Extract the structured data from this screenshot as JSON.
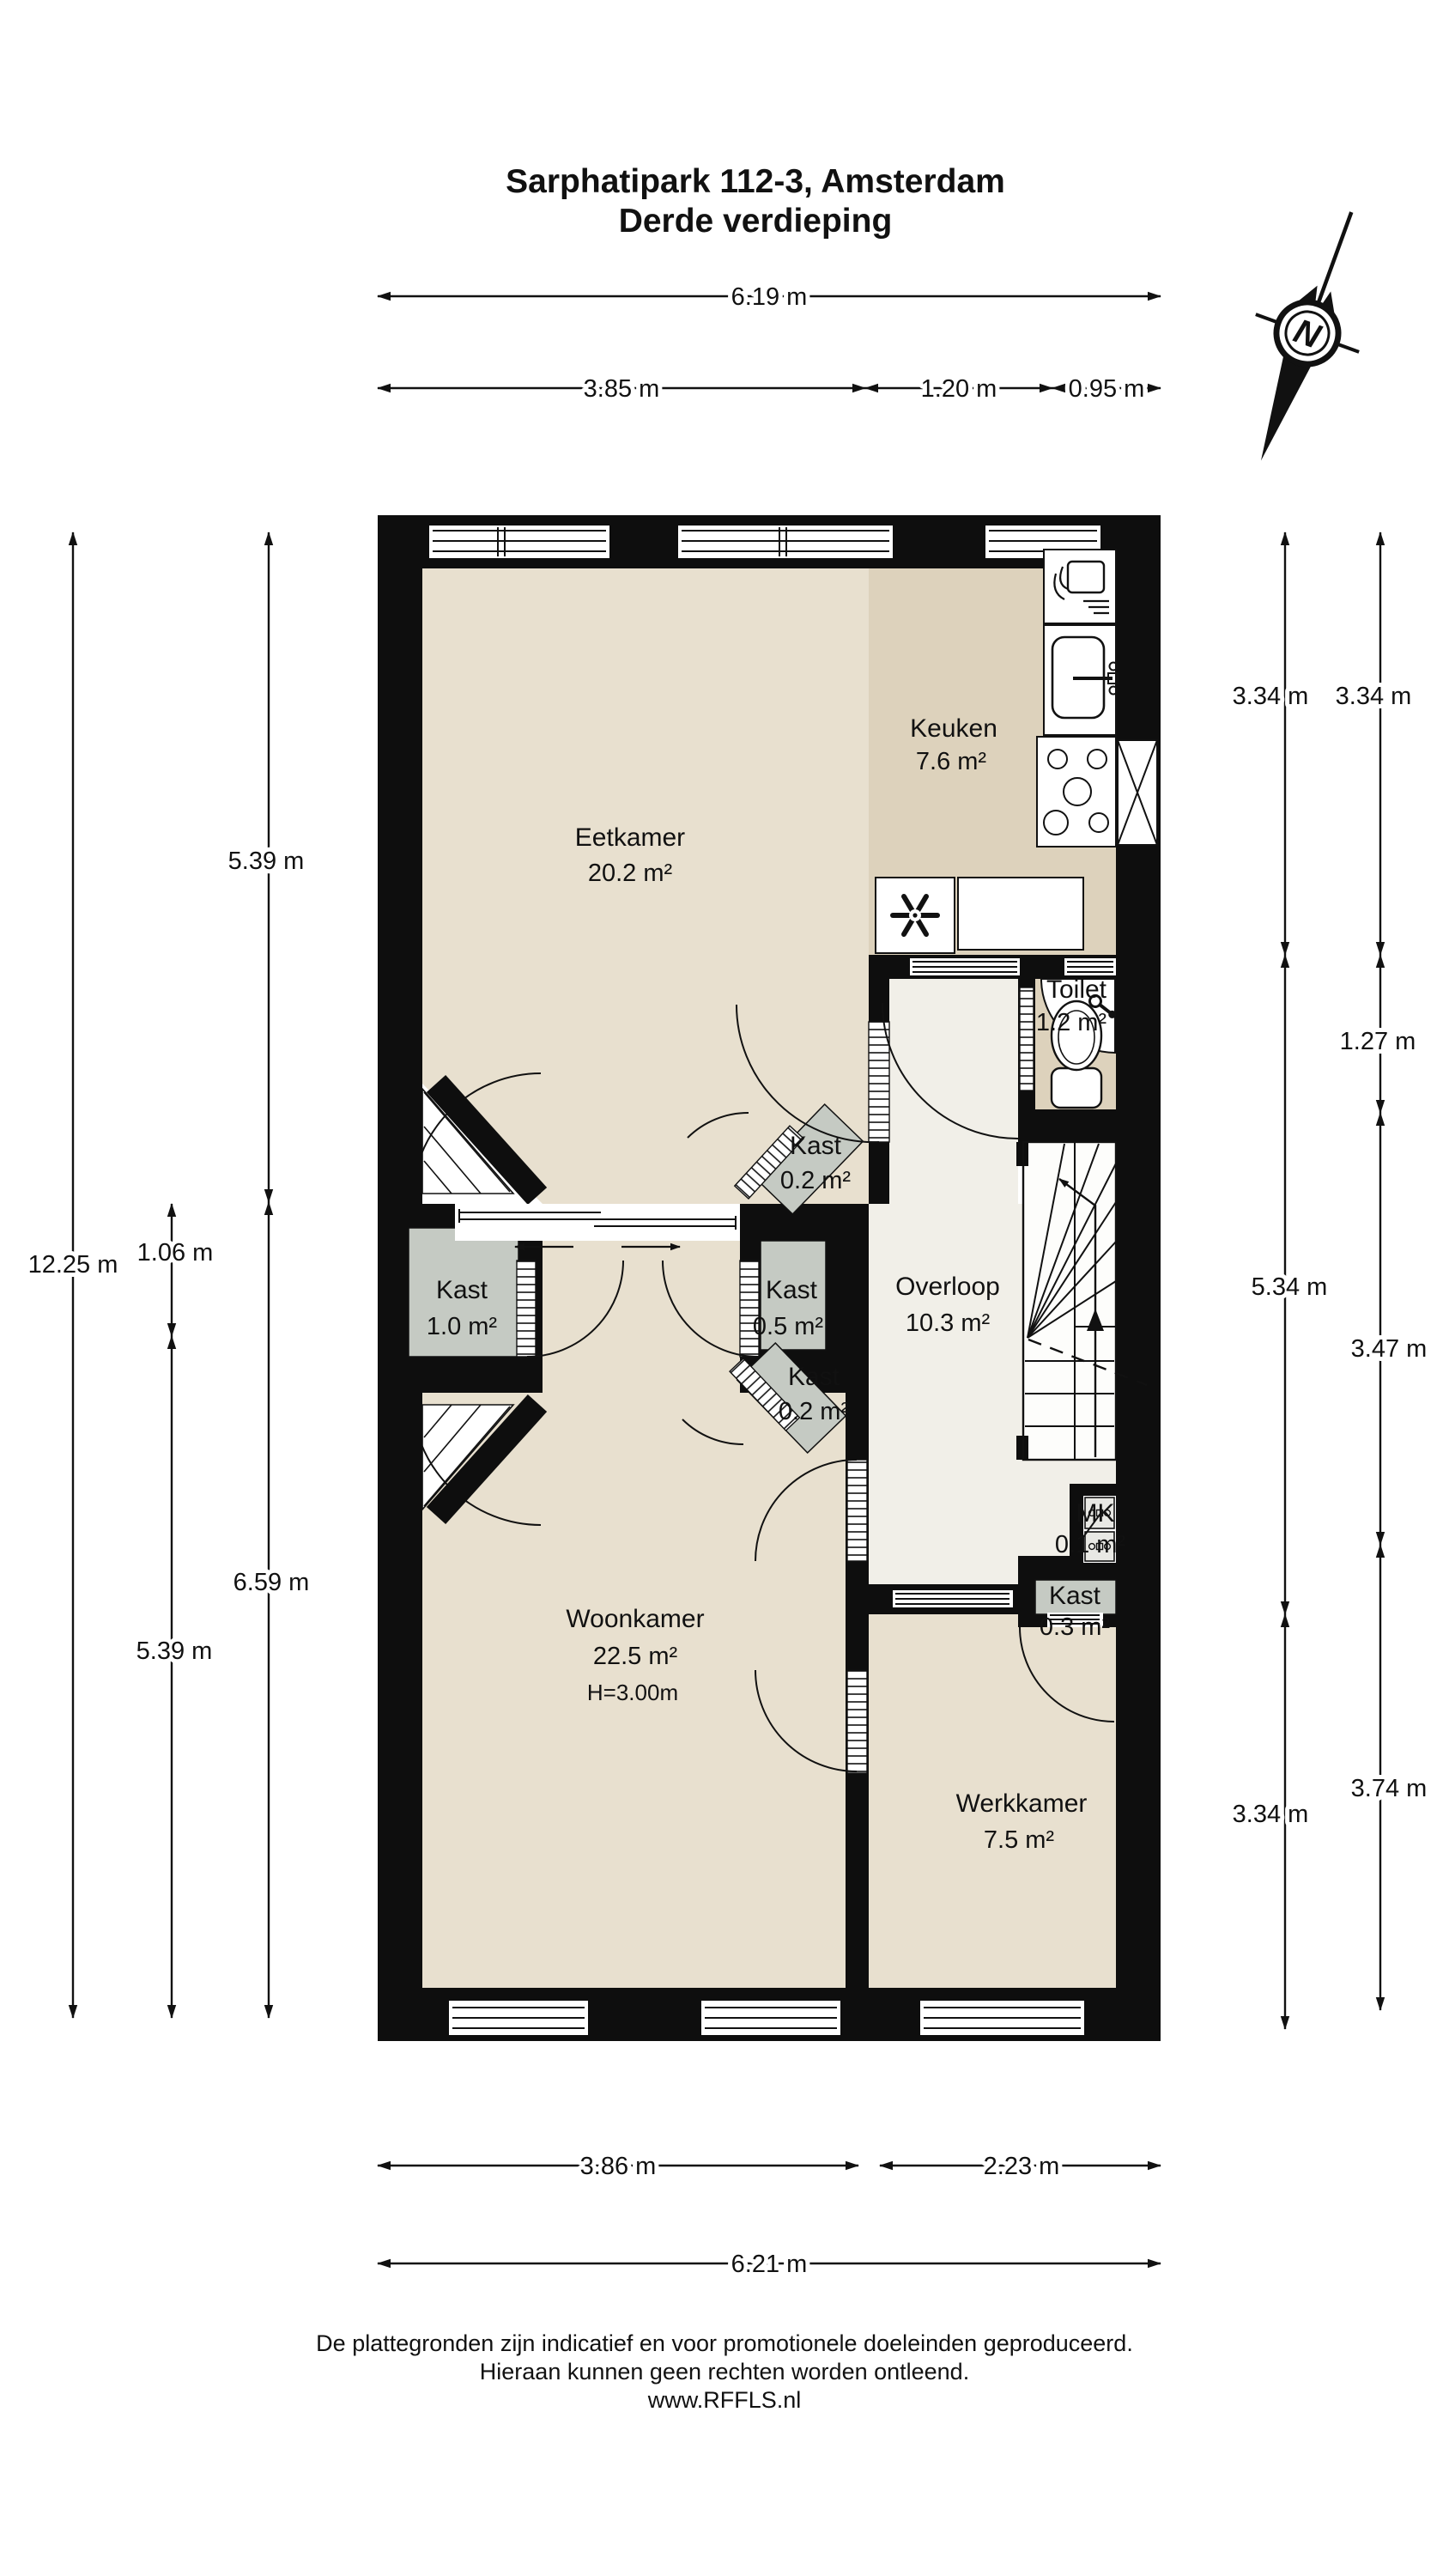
{
  "title": {
    "address": "Sarphatipark 112-3, Amsterdam",
    "floor": "Derde verdieping"
  },
  "compass": {
    "letter": "N"
  },
  "rooms": {
    "eetkamer": {
      "name": "Eetkamer",
      "area": "20.2 m²"
    },
    "keuken": {
      "name": "Keuken",
      "area": "7.6 m²"
    },
    "toilet": {
      "name": "Toilet",
      "area": "1.2 m²"
    },
    "overloop": {
      "name": "Overloop",
      "area": "10.3 m²"
    },
    "woonkamer": {
      "name": "Woonkamer",
      "area": "22.5 m²",
      "ceiling_height": "H=3.00m"
    },
    "werkkamer": {
      "name": "Werkkamer",
      "area": "7.5 m²"
    },
    "mk": {
      "name": "MK",
      "area": "0.1 m²"
    },
    "kast_upper_02": {
      "name": "Kast",
      "area": "0.2 m²"
    },
    "kast_10": {
      "name": "Kast",
      "area": "1.0 m²"
    },
    "kast_05": {
      "name": "Kast",
      "area": "0.5 m²"
    },
    "kast_lower_02": {
      "name": "Kast",
      "area": "0.2 m²"
    },
    "kast_03": {
      "name": "Kast",
      "area": "0.3 m²"
    }
  },
  "dimensions": {
    "top_total": "6.19 m",
    "top_left": "3.85 m",
    "top_mid": "1.20 m",
    "top_right": "0.95 m",
    "left_total": "12.25 m",
    "left_inner_upper": "5.39 m",
    "left_kast": "1.06 m",
    "left_inner_lower": "6.59 m",
    "left_lower": "5.39 m",
    "right_inner_top": "3.34 m",
    "right_outer_top": "3.34 m",
    "right_toilet": "1.27 m",
    "right_inner_mid": "5.34 m",
    "right_outer_mid": "3.47 m",
    "right_inner_bottom": "3.34 m",
    "right_outer_bottom": "3.74 m",
    "bottom_left": "3.86 m",
    "bottom_right": "2.23 m",
    "bottom_total": "6.21 m"
  },
  "footer": {
    "line1": "De plattegronden zijn indicatief en voor promotionele doeleinden geproduceerd.",
    "line2": "Hieraan kunnen geen rechten worden ontleend.",
    "line3": "www.RFFLS.nl"
  },
  "colors": {
    "floor_light": "#e8e0cf",
    "floor_dark": "#ddd2bc",
    "floor_hall": "#f1efe8",
    "closet_gray": "#c5cac3",
    "wall": "#0e0e0e",
    "background": "#ffffff"
  }
}
